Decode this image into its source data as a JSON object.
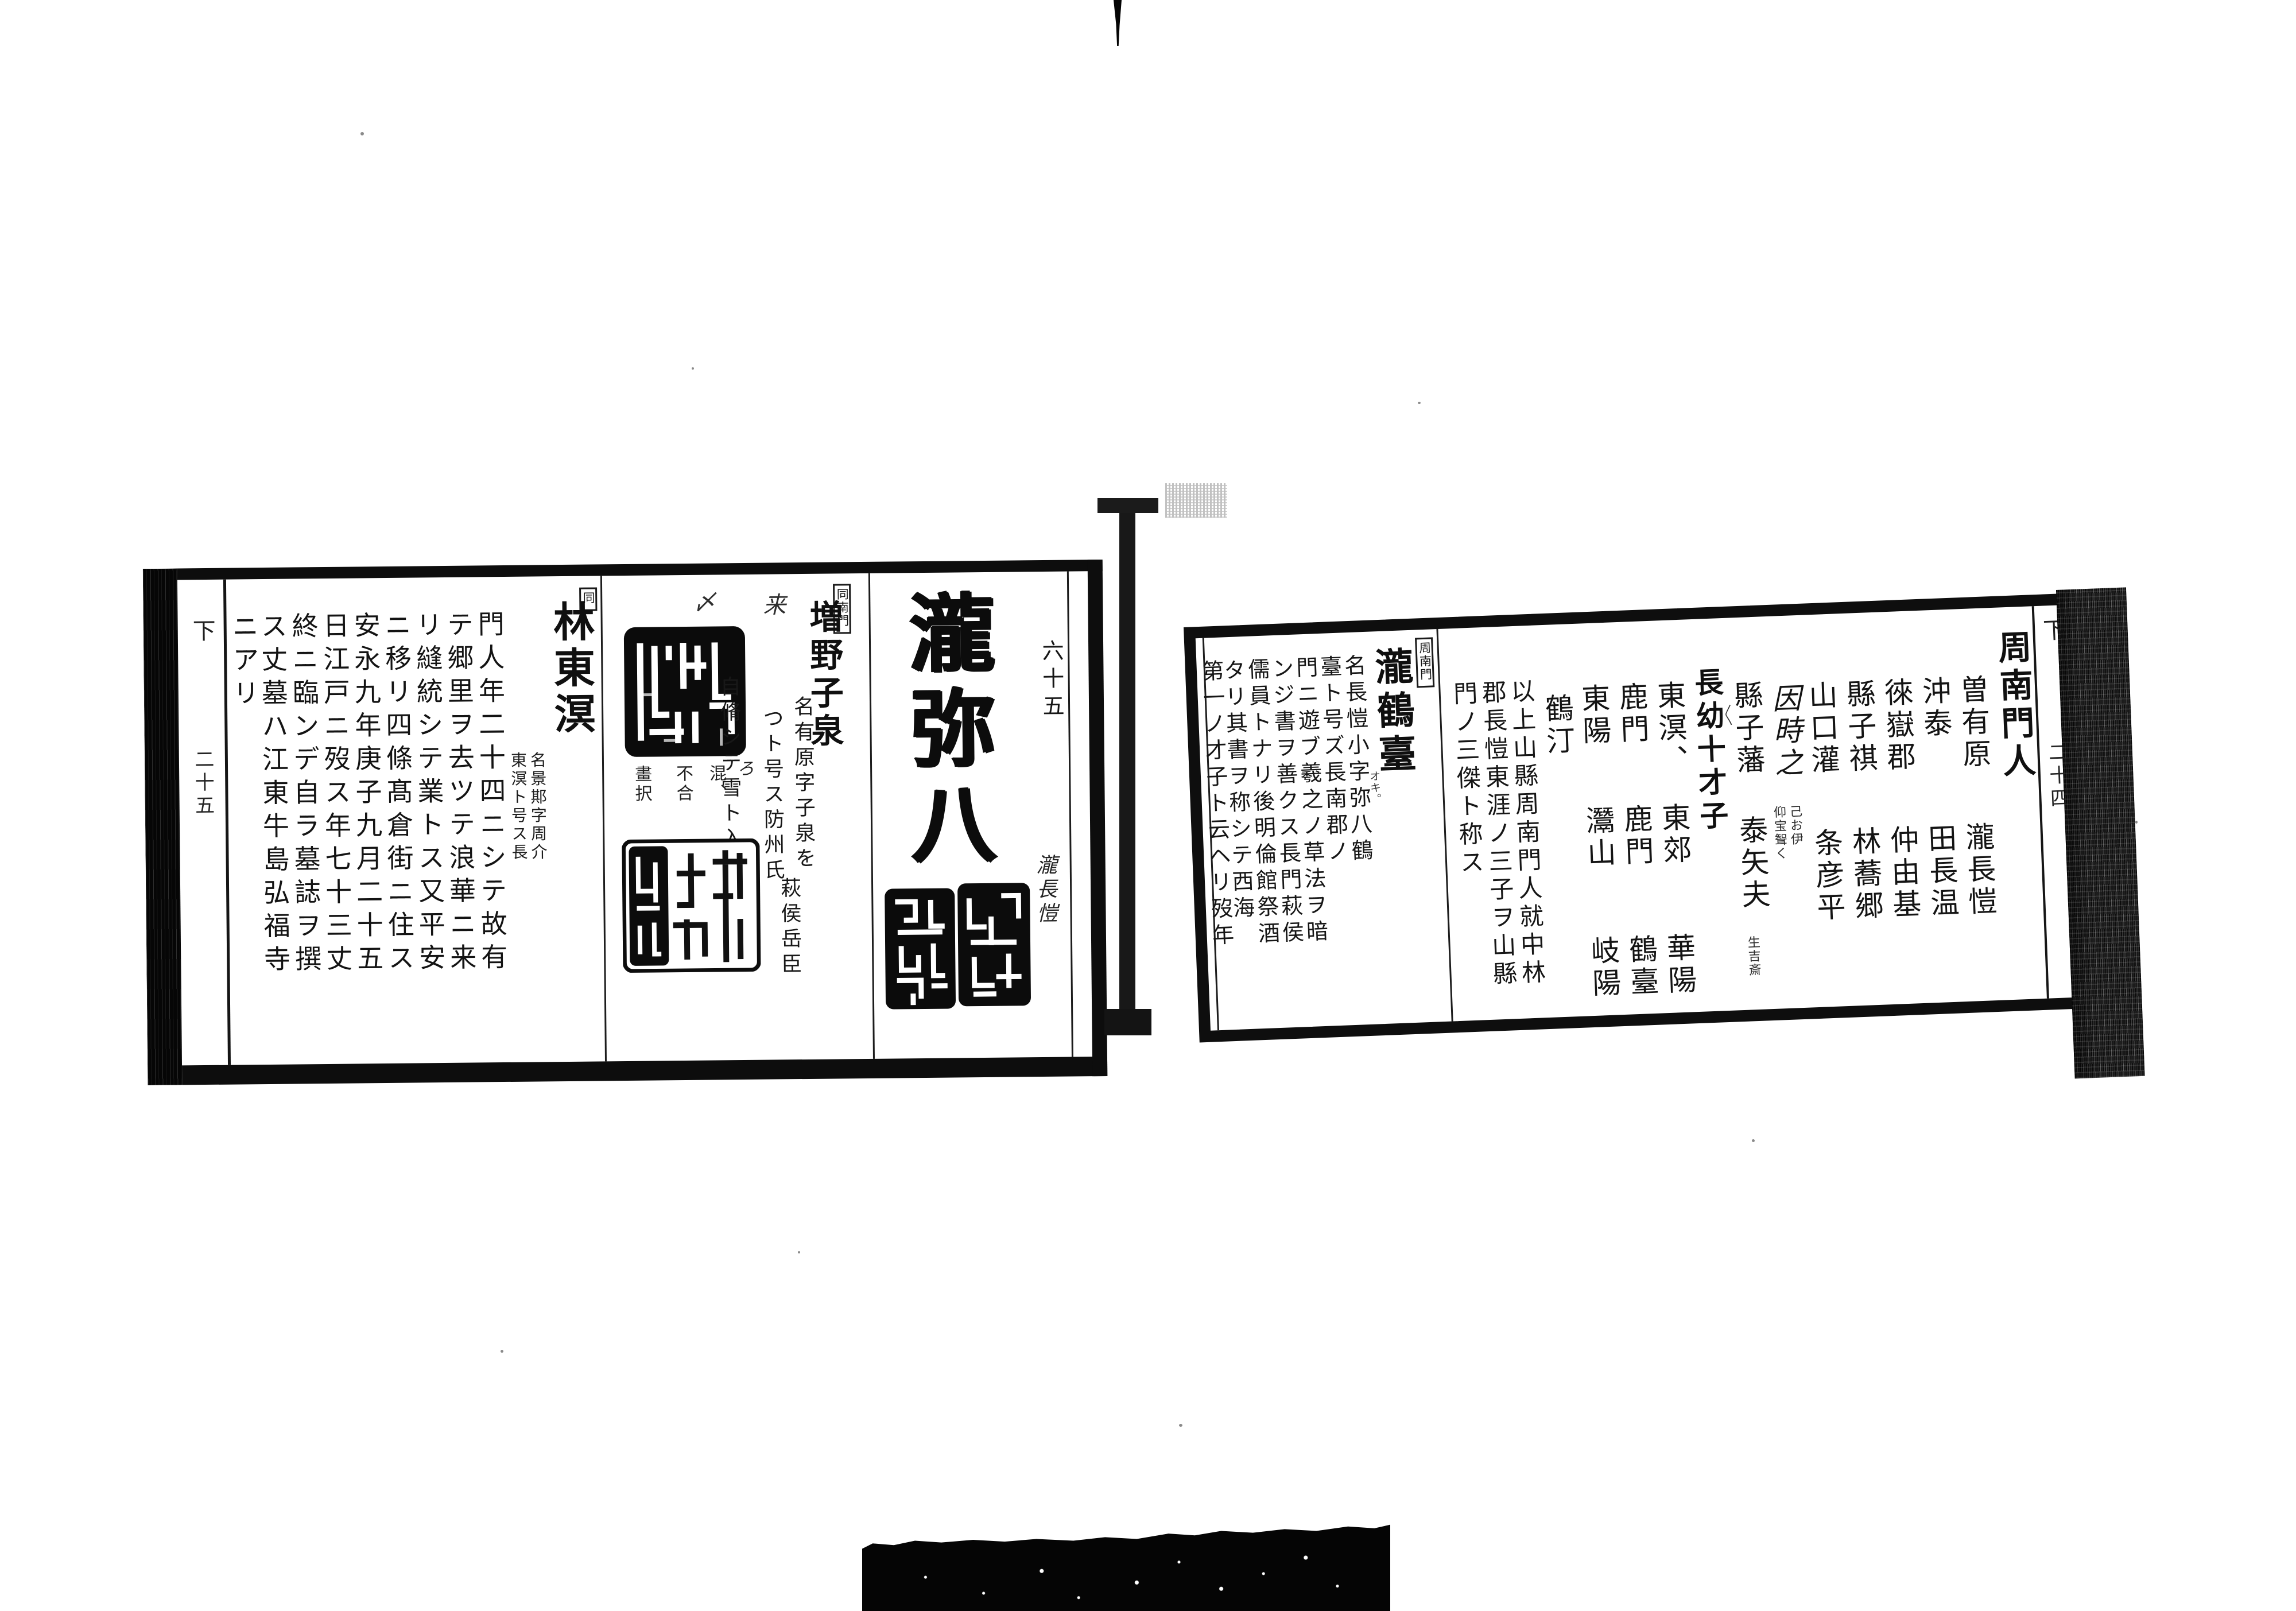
{
  "artifacts": {
    "fold_bar": "center-fold-bar",
    "binding_band": "left-binding-band",
    "fore_edge_band": "right-fore-edge-band",
    "seals": [
      "taki-seal-left",
      "taki-seal-right",
      "masuno-seal-top",
      "masuno-seal-bottom"
    ]
  },
  "left_page": {
    "volume_marker": "下",
    "page_number": "二十五",
    "specimen": {
      "folio_number": "六十五",
      "calligraphy": "瀧弥八",
      "signature": "瀧長愷"
    },
    "masuno": {
      "section_label": "同南門",
      "name": "増野子泉",
      "marks": [
        "来",
        "〆"
      ],
      "bio_lines": [
        "名有原字子泉を",
        "つト号ス防州氏",
        "自脩シテ雪ト入",
        "萩侯岳臣"
      ],
      "seal_notes": [
        "ろ",
        "混、",
        "不合",
        "畫択"
      ]
    },
    "hayashi": {
      "section_label": "同",
      "name": "林東溟",
      "annotation": [
        "名景𨛺字周介",
        "東溟ト号ス長"
      ],
      "bio_lines": [
        "門人年二十四ニシテ故有",
        "テ郷里ヲ去ツテ浪華ニ来",
        "リ縫統シテ業トス又平安",
        "ニ移リ四條髙倉街ニ住ス",
        "安永九年庚子九月二十五",
        "日江戸ニ歿ス年七十三丈",
        "終ニ臨ンデ自ラ墓誌ヲ撰",
        "ス丈墓ハ江東牛島弘福寺",
        "ニアリ"
      ]
    }
  },
  "right_page": {
    "volume_marker": "下",
    "page_number": "二十四",
    "monjin": {
      "header": "周南門人",
      "pairs": [
        {
          "top": "曽有原",
          "bottom": "瀧長愷"
        },
        {
          "top": "沖泰",
          "bottom": "田長温"
        },
        {
          "top": "徠嶽郡",
          "bottom": "仲由基"
        },
        {
          "top": "縣子祺",
          "bottom": "林蕎郷"
        },
        {
          "top": "山口灌",
          "bottom": "条彦平"
        },
        {
          "top": "因時之",
          "bottom": "仰宝聟く"
        },
        {
          "top": "縣子藩",
          "bottom": "泰矢夫"
        }
      ],
      "annot_small_right": "己お伊",
      "pair7_furigana": "〳〵",
      "pair7_small": "生吉斎",
      "subheader": "長幼十才子",
      "talents": [
        [
          "東溟、",
          "東郊",
          "華陽"
        ],
        [
          "鹿門",
          "鹿門",
          "鶴臺"
        ],
        [
          "東陽",
          "灊山",
          "岐陽"
        ],
        [
          "鶴汀",
          "",
          ""
        ]
      ],
      "closing": [
        "以上山縣周南門人就中林",
        "郡長愷東涯ノ三子ヲ山縣",
        "門ノ三傑ト称ス"
      ]
    },
    "biography": {
      "section_label": "周南門",
      "name": "瀧鶴臺",
      "furigana": "オキ。",
      "lines": [
        "名長愷小字弥八鶴",
        "臺ト号ズ長南郡ノ",
        "門ニ遊ブ羲之ノ草法ヲ暗",
        "ンジ書ヲ善クス長門萩侯",
        "儒員トナリ後明倫館祭酒",
        "タリ其書ヲ称シテ西海",
        "第一ノ才子ト云ヘリ歿年"
      ]
    }
  }
}
